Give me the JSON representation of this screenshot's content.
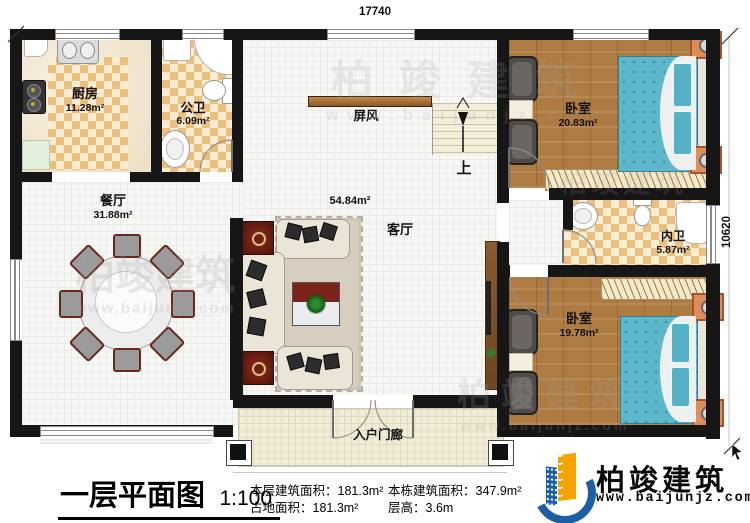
{
  "plan": {
    "dim_top": "17740",
    "dim_right": "10620",
    "rooms": {
      "kitchen": {
        "name": "厨房",
        "area": "11.28m²"
      },
      "public_bath": {
        "name": "公卫",
        "area": "6.09m²"
      },
      "dining": {
        "name": "餐厅",
        "area": "31.88m²"
      },
      "living": {
        "name": "客厅",
        "area": "54.84m²"
      },
      "bedroom1": {
        "name": "卧室",
        "area": "20.83m²"
      },
      "inner_bath": {
        "name": "内卫",
        "area": "5.87m²"
      },
      "bedroom2": {
        "name": "卧室",
        "area": "19.78m²"
      },
      "porch": {
        "name": "入户门廊"
      }
    },
    "labels": {
      "screen": "屏风",
      "stairs_up": "上"
    }
  },
  "footer": {
    "title": "一层平面图",
    "scale": "1:100",
    "stats": [
      {
        "label": "本层建筑面积：",
        "value": "181.3m²"
      },
      {
        "label": "占地面积：",
        "value": "181.3m²"
      },
      {
        "label": "本栋建筑面积：",
        "value": "347.9m²"
      },
      {
        "label": "层高：",
        "value": "3.6m"
      }
    ],
    "brand": {
      "name": "柏竣建筑",
      "url": "www.baijunjz.com"
    }
  },
  "watermark": {
    "brand": "柏竣建筑",
    "url": "www.baijunjz.com"
  }
}
